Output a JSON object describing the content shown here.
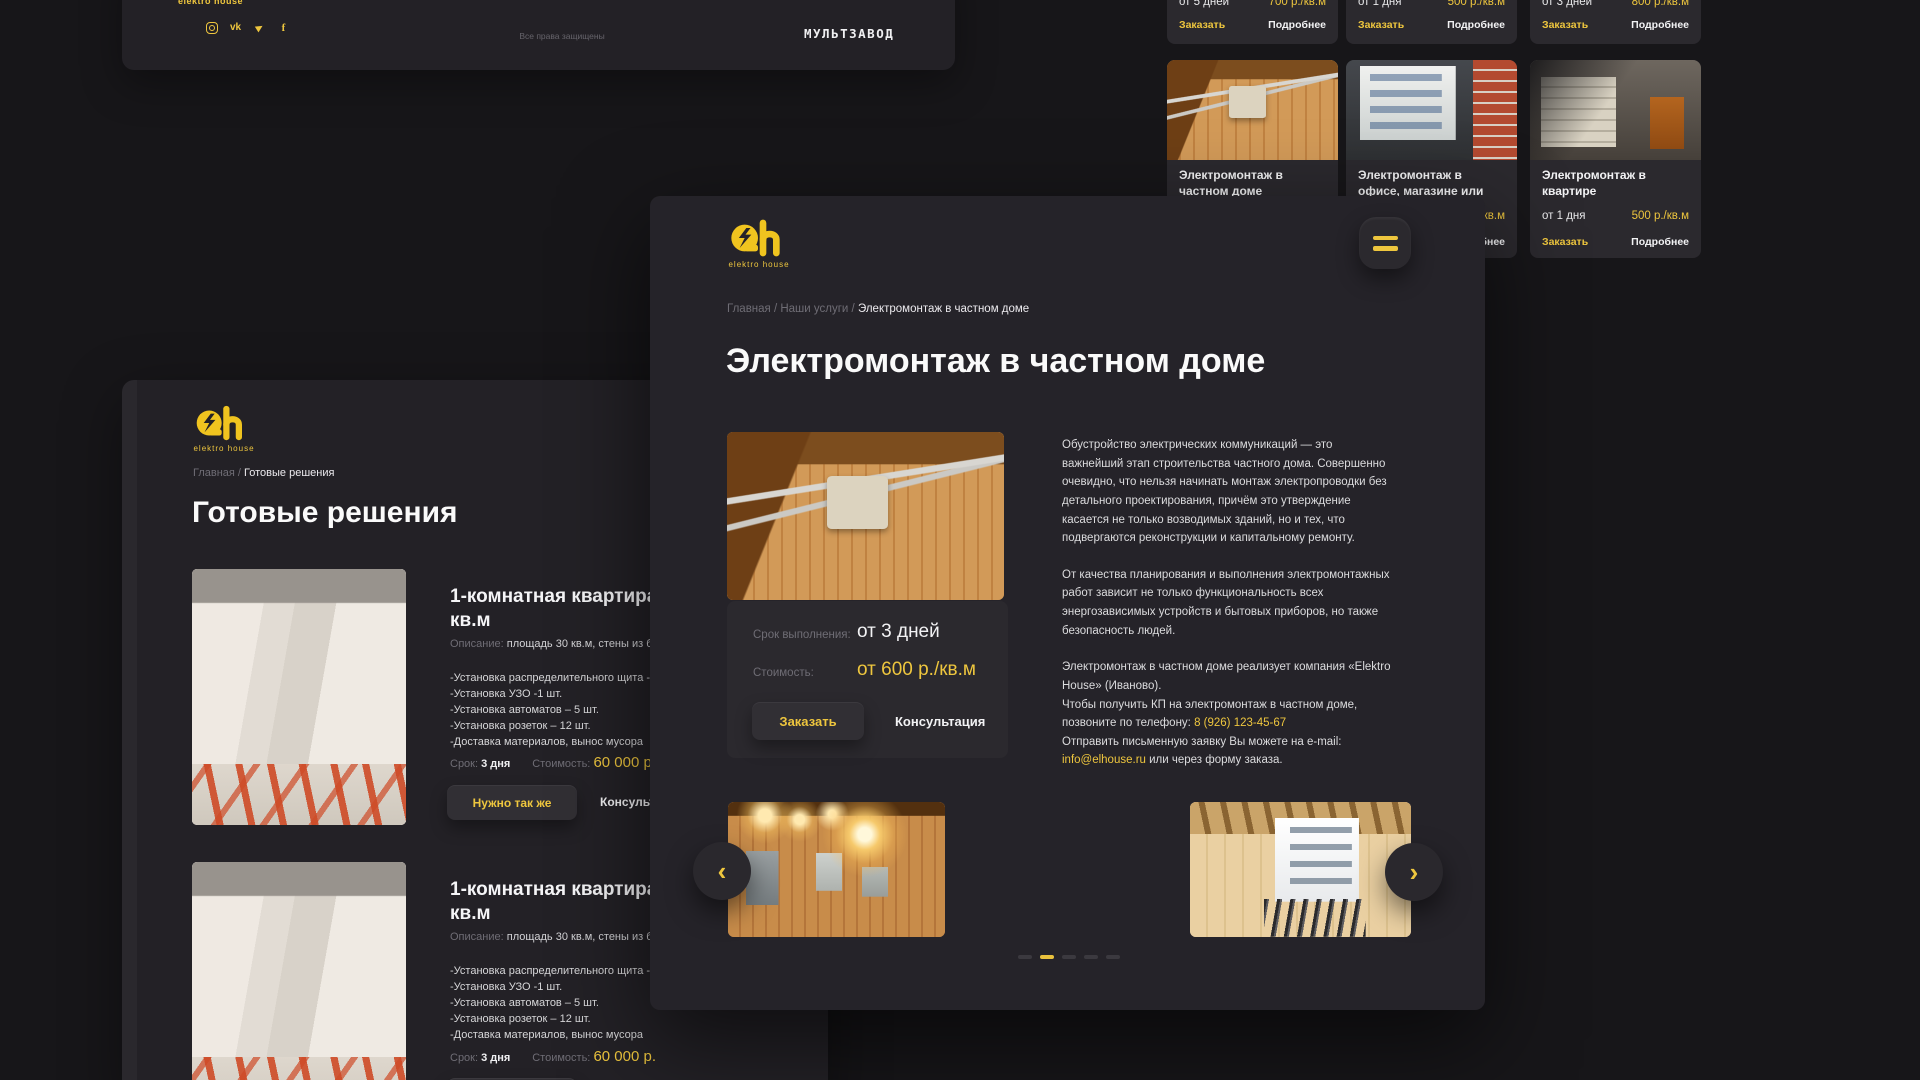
{
  "colors": {
    "accent": "#eec63e",
    "background": "#171619",
    "panel": "#232126",
    "card": "#2b292e"
  },
  "footer_bar": {
    "logo_text": "elektro house",
    "copyright": "Все права защищены",
    "studio": "МУЛЬТЗАВОД",
    "icon_glyphs": {
      "vk": "vk",
      "telegram": "▶",
      "facebook": "f"
    }
  },
  "services_page": {
    "row_top": [
      {
        "term": "от 5 дней",
        "price": "700 р./кв.м",
        "order": "Заказать",
        "more": "Подробнее"
      },
      {
        "term": "от 1 дня",
        "price": "500 р./кв.м",
        "order": "Заказать",
        "more": "Подробнее"
      },
      {
        "term": "от 3 дней",
        "price": "800 р./кв.м",
        "order": "Заказать",
        "more": "Подробнее"
      }
    ],
    "row_bottom": [
      {
        "title": "Электромонтаж в частном доме"
      },
      {
        "title": "Электромонтаж в офисе, магазине или кафе",
        "term": "",
        "price": "500 р./кв.м",
        "order": "Заказать",
        "more": "Подробнее"
      },
      {
        "title": "Электромонтаж в квартире",
        "term": "от 1 дня",
        "price": "500 р./кв.м",
        "order": "Заказать",
        "more": "Подробнее"
      }
    ]
  },
  "solutions_page": {
    "brand": "elektro house",
    "breadcrumb": {
      "trail": "Главная /",
      "current": "Готовые решения"
    },
    "title": "Готовые решения",
    "cards": [
      {
        "title": "1-комнатная квартира, 30 кв.м",
        "desc_label": "Описание:",
        "desc": "площадь 30 кв.м, стены из бетона.",
        "features": [
          "-Установка распределительного щита - 1шт.",
          "-Установка УЗО -1 шт.",
          "-Установка автоматов – 5 шт.",
          "-Установка розеток – 12 шт.",
          "-Доставка материалов, вынос мусора"
        ],
        "term_label": "Срок:",
        "term": "3 дня",
        "price_label": "Стоимость:",
        "price": "60 000 р.",
        "need_button": "Нужно так же",
        "consult_button": "Консультация"
      },
      {
        "title": "1-комнатная квартира, 30 кв.м",
        "desc_label": "Описание:",
        "desc": "площадь 30 кв.м, стены из бетона.",
        "features": [
          "-Установка распределительного щита - 1шт.",
          "-Установка УЗО -1 шт.",
          "-Установка автоматов – 5 шт.",
          "-Установка розеток – 12 шт.",
          "-Доставка материалов, вынос мусора"
        ],
        "term_label": "Срок:",
        "term": "3 дня",
        "price_label": "Стоимость:",
        "price": "60 000 р.",
        "need_button": "Нужно так же",
        "consult_button": "Консультация"
      }
    ]
  },
  "service_page": {
    "brand": "elektro house",
    "breadcrumb": {
      "trail": "Главная / Наши услуги /",
      "current": "Электромонтаж в частном доме"
    },
    "title": "Электромонтаж в частном доме",
    "details": {
      "term_label": "Срок выполнения:",
      "term": "от 3 дней",
      "price_label": "Стоимость:",
      "price": "от 600 р./кв.м",
      "order_button": "Заказать",
      "consult_button": "Консультация"
    },
    "paragraphs": {
      "p1": "Обустройство электрических коммуникаций — это важнейший этап строительства частного дома. Совершенно очевидно, что нельзя начинать монтаж электропроводки без детального проектирования, причём это утверждение касается не только возводимых зданий, но и тех, что подвергаются реконструкции и капитальному ремонту.",
      "p2": "От качества планирования и выполнения электромонтажных работ зависит не только функциональность всех энергозависимых устройств и бытовых приборов, но также безопасность людей.",
      "p3a": "Электромонтаж в частном доме реализует компания «Elektro House» (Иваново).",
      "p3b": "Чтобы получить КП на электромонтаж в частном доме, позвоните по телефону: ",
      "phone": "8 (926) 123-45-67",
      "p3c": "Отправить письменную заявку Вы можете на e-mail: ",
      "email": "info@elhouse.ru",
      "p3d": " или через форму заказа."
    },
    "carousel": {
      "prev_icon": "‹",
      "next_icon": "›",
      "dot_count": 5,
      "active_dot": 2
    }
  }
}
